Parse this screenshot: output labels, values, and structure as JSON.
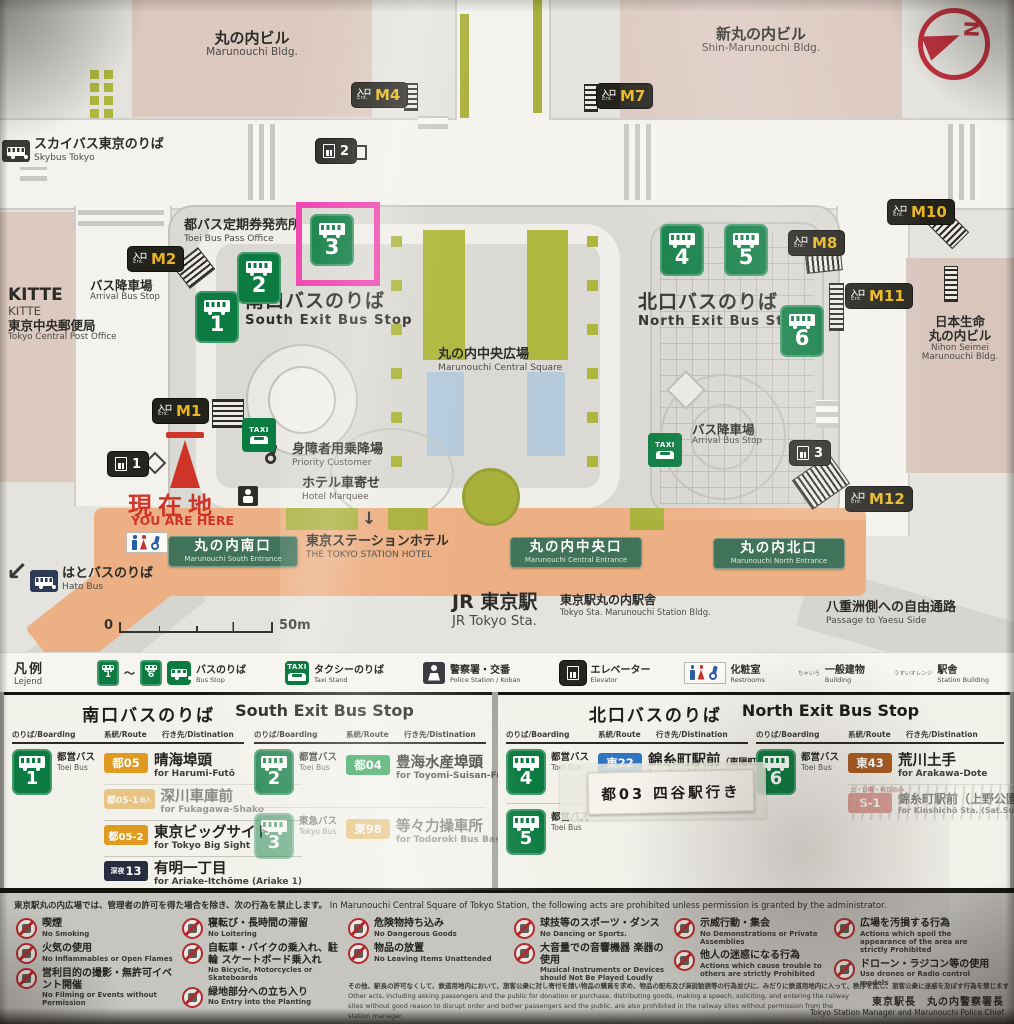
{
  "map": {
    "ent_jp": "入口",
    "ent_en": "Ent.",
    "m1": "M1",
    "m2": "M2",
    "m4": "M4",
    "m7": "M7",
    "m8": "M8",
    "m10": "M10",
    "m11": "M11",
    "m12": "M12",
    "stops": [
      "1",
      "2",
      "3",
      "4",
      "5",
      "6"
    ],
    "elevs": [
      "1",
      "2",
      "3"
    ],
    "taxi": "TAXI",
    "compass_n": "N",
    "marunouchi_bldg_jp": "丸の内ビル",
    "marunouchi_bldg_en": "Marunouchi Bldg.",
    "shin_marunouchi_jp": "新丸の内ビル",
    "shin_marunouchi_en": "Shin-Marunouchi Bldg.",
    "skybus_jp": "スカイバス東京のりば",
    "skybus_en": "Skybus Tokyo",
    "kitte": "KITTE",
    "kitte_sub": "KITTE",
    "post_jp": "東京中央郵便局",
    "post_en": "Tokyo Central Post Office",
    "pass_jp": "都バス定期券発売所",
    "pass_en": "Toei Bus Pass Office",
    "arrival_jp": "バス降車場",
    "arrival_en": "Arrival Bus Stop",
    "south_jp": "南口バスのりば",
    "south_en": "South Exit Bus Stop",
    "north_jp": "北口バスのりば",
    "north_en": "North Exit Bus Stop",
    "square_jp": "丸の内中央広場",
    "square_en": "Marunouchi Central Square",
    "nihon_jp1": "日本生命",
    "nihon_jp2": "丸の内ビル",
    "nihon_en1": "Nihon Seimei",
    "nihon_en2": "Marunouchi Bldg.",
    "priority_jp": "身障者用乗降場",
    "priority_en": "Priority Customer",
    "marquee_jp": "ホテル車寄せ",
    "marquee_en": "Hotel Marquee",
    "here_jp": "現在地",
    "here_en": "YOU ARE HERE",
    "hotel_jp": "東京ステーションホテル",
    "hotel_en": "THE TOKYO STATION HOTEL",
    "sent_jp": "丸の内南口",
    "sent_en": "Marunouchi South Entrance",
    "cent_jp": "丸の内中央口",
    "cent_en": "Marunouchi Central Entrance",
    "nent_jp": "丸の内北口",
    "nent_en": "Marunouchi North Entrance",
    "jr_jp": "JR 東京駅",
    "jr_en": "JR Tokyo Sta.",
    "stnbldg_jp": "東京駅丸の内駅舎",
    "stnbldg_en": "Tokyo Sta. Marunouchi Station Bldg.",
    "yaesu_jp": "八重洲側への自由通路",
    "yaesu_en": "Passage to Yaesu Side",
    "hato_jp": "はとバスのりば",
    "hato_en": "Hato Bus",
    "scale0": "0",
    "scale50": "50m",
    "down_arrow": "↓",
    "sw_arrow": "↙"
  },
  "legend": {
    "title_jp": "凡例",
    "title_en": "Lejend",
    "tilde": "〜",
    "bus_jp": "バスのりば",
    "bus_en": "Bus Stop",
    "taxi_jp": "タクシーのりば",
    "taxi_en": "Taxi Stand",
    "police_jp": "警察署・交番",
    "police_en": "Police Station / Koban",
    "elev_jp": "エレベーター",
    "elev_en": "Elevator",
    "wc_jp": "化粧室",
    "wc_en": "Restrooms",
    "bldg_jp": "一般建物",
    "bldg_en": "Building",
    "bldg_note": "ちゃいろ",
    "stn_jp": "駅舎",
    "stn_en": "Station Building",
    "stn_note": "うすいオレンジ"
  },
  "south": {
    "title_jp": "南口バスのりば",
    "title_en": "South Exit Bus Stop",
    "h_board": "のりば/Boarding",
    "h_route": "系統/Route",
    "h_dest": "行き先/Distination",
    "s1": {
      "num": "1",
      "op_jp": "都営バス",
      "op_en": "Toei Bus"
    },
    "r11": {
      "badge": "都05",
      "jp": "晴海埠頭",
      "en": "for Harumi-Futō"
    },
    "r12": {
      "badge": "都05-1",
      "badge2": "出入",
      "jp": "深川車庫前",
      "en": "for Fukagawa-Shako"
    },
    "r13": {
      "badge": "都05-2",
      "jp": "東京ビッグサイト",
      "en": "for Tokyo Big Sight"
    },
    "r14": {
      "badge1": "深夜",
      "badge": "13",
      "jp": "有明一丁目",
      "en": "for Ariake-Itchōme (Ariake 1)"
    },
    "s2": {
      "num": "2",
      "op_jp": "都営バス",
      "op_en": "Toei Bus"
    },
    "r21": {
      "badge": "都04",
      "jp": "豊海水産埠頭",
      "en": "for Toyomi-Suisan-Futō"
    },
    "s3": {
      "num": "3",
      "op_jp": "東急バス",
      "op_en": "Tokyu Bus"
    },
    "r31": {
      "badge": "東98",
      "jp": "等々力操車所",
      "en": "for Todoroki Bus Base"
    }
  },
  "north": {
    "title_jp": "北口バスのりば",
    "title_en": "North Exit Bus Stop",
    "h_board": "のりば/Boarding",
    "h_route": "系統/Route",
    "h_dest": "行き先/Distination",
    "s4": {
      "num": "4",
      "op_jp": "都営バス",
      "op_en": "Toei Bus"
    },
    "r41": {
      "badge": "東22",
      "jp": "錦糸町駅前",
      "jp2": "（東陽町駅前経由）",
      "en": "for Kinshichō Sta.",
      "en2": "via Tōyōchō Sta."
    },
    "s5": {
      "num": "5",
      "op_jp": "都営バス",
      "op_en": "Toei Bus"
    },
    "sticker": "都03 四谷駅行き",
    "s6": {
      "num": "6",
      "op_jp": "都営バス",
      "op_en": "Toei Bus"
    },
    "r61": {
      "badge": "東43",
      "jp": "荒川土手",
      "en": "for Arakawa-Dote"
    },
    "r62": {
      "note": "土・日曜・祝日のみ",
      "badge": "S-1",
      "jp": "錦糸町駅前（上野公園経由）",
      "en": "for Kinshichō Sta. (Sat.Sun.Holiday Only)"
    }
  },
  "rules": {
    "header_jp": "東京駅丸の内広場では、管理者の許可を得た場合を除き、次の行為を禁止します。",
    "header_en": "In Marunouchi Central Square of Tokyo Station, the following acts are prohibited unless permission is granted by the administrator.",
    "c1": [
      {
        "jp": "喫煙",
        "en": "No Smoking"
      },
      {
        "jp": "火気の使用",
        "en": "No Inflammables or Open Flames"
      },
      {
        "jp": "営利目的の撮影・無許可イベント開催",
        "en": "No Filming or Events without Permission"
      }
    ],
    "c2": [
      {
        "jp": "寝転び・長時間の滞留",
        "en": "No Loitering"
      },
      {
        "jp": "自転車・バイクの乗入れ、駐輪 スケートボード乗入れ",
        "en": "No Bicycle, Motorcycles or Skateboards"
      },
      {
        "jp": "緑地部分への立ち入り",
        "en": "No Entry into the Planting"
      }
    ],
    "c3": [
      {
        "jp": "危険物持ち込み",
        "en": "No Dangerous Goods"
      },
      {
        "jp": "物品の放置",
        "en": "No Leaving Items Unattended"
      }
    ],
    "c4": [
      {
        "jp": "球技等のスポーツ・ダンス",
        "en": "No Dancing or Sports."
      },
      {
        "jp": "大音量での音響機器 楽器の使用",
        "en": "Musical Instruments or Devices should Not Be Played Loudly"
      }
    ],
    "c5": [
      {
        "jp": "示威行動・集会",
        "en": "No Demonstrations or Private Assemblies"
      },
      {
        "jp": "他人の迷惑になる行為",
        "en": "Actions which cause trouble to others are strictly Prohibited"
      }
    ],
    "c6": [
      {
        "jp": "広場を汚損する行為",
        "en": "Actions which spoil the appearance of the area are strictly Prohibited"
      },
      {
        "jp": "ドローン・ラジコン等の使用",
        "en": "Use drones or Radio control models"
      }
    ],
    "fine_jp": "その他、駅長の許可なくして、鉄道用地内において、旅客公衆に対し寄付を請い物品の購買を求め、物品の配布及び演説勧誘等の行為並びに、みだりに鉄道用地内に入って、秩序を乱し、旅客公衆に迷惑を及ぼす行為を禁じます。",
    "fine_en": "Other acts, including asking passengers and the public for donation or purchase, distributing goods, making a speech, soliciting, and entering the railway sites without good reason to disrupt order and bother passengers and the public, are also prohibited in the railway sites without permission from the station manager.",
    "sign_jp": "東京駅長　丸の内警察署長",
    "sign_en": "Tokyo Station Manager and Marunouchi Police Chief"
  }
}
